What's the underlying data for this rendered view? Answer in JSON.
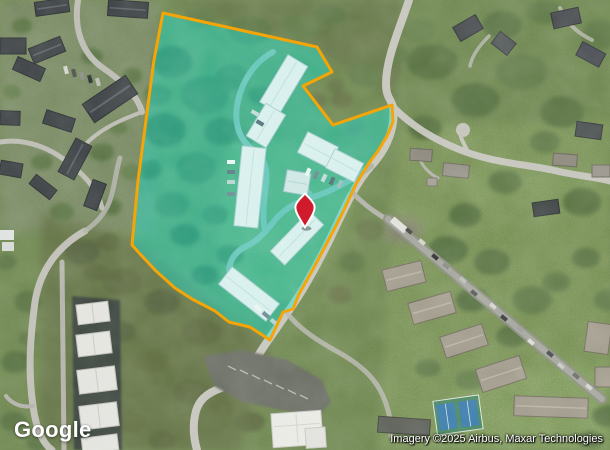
{
  "branding": {
    "logo_text": "Google"
  },
  "attribution": {
    "text": "Imagery ©2025 Airbus, Maxar Technologies"
  },
  "overlay": {
    "parcel_fill": "rgba(0,232,220,0.40)",
    "parcel_stroke": "#F5A506",
    "pin_fill": "#CF1B2B",
    "pin_stroke": "#FFFFFF"
  }
}
